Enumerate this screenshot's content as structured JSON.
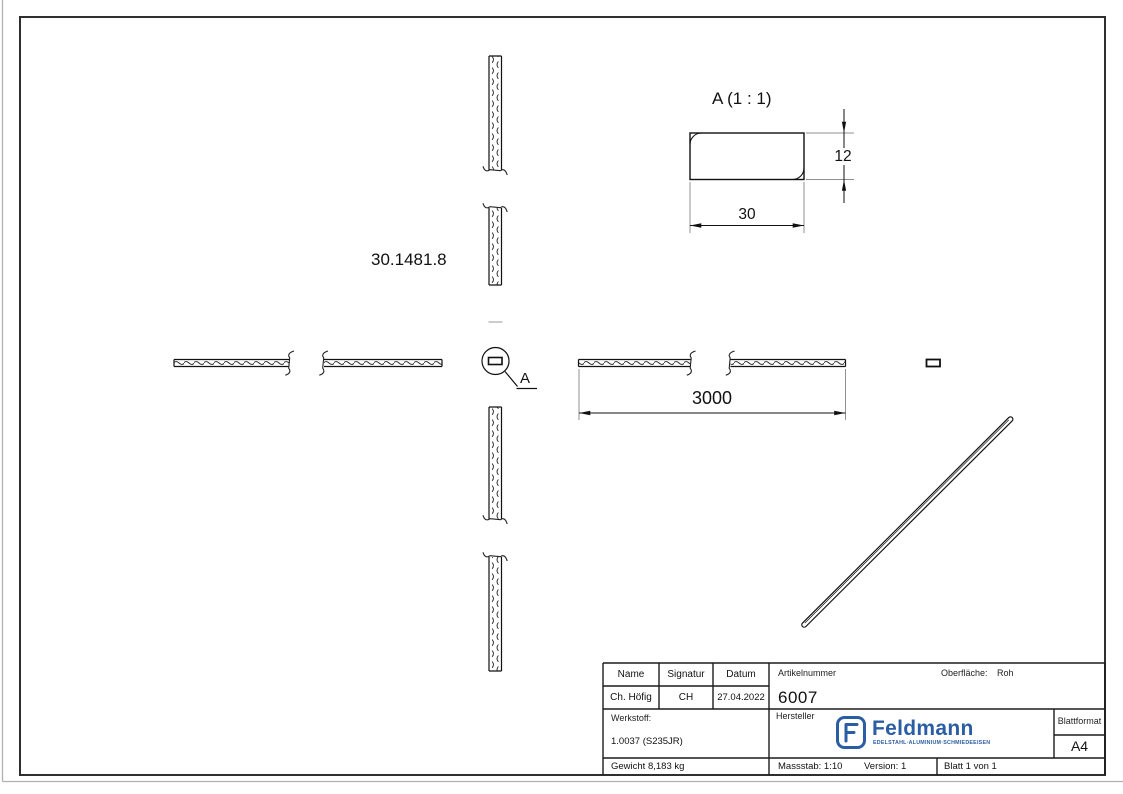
{
  "sheet": {
    "part_number": "30.1481.8",
    "detail_title": "A (1 : 1)",
    "dim_height": "12",
    "dim_width": "30",
    "dim_length": "3000",
    "callout_label": "A"
  },
  "title_block": {
    "col_name": "Name",
    "col_signature": "Signatur",
    "col_date": "Datum",
    "name": "Ch. Höfig",
    "signature": "CH",
    "date": "27.04.2022",
    "article_label": "Artikelnummer",
    "article_value": "6007",
    "surface_label": "Oberfläche:",
    "surface_value": "Roh",
    "material_label": "Werkstoff:",
    "material_value": "1.0037 (S235JR)",
    "manufacturer_label": "Hersteller",
    "brand": "Feldmann",
    "brand_tagline": "EDELSTAHL·ALUMINIUM·SCHMIEDEEISEN",
    "brand_color": "#2b5da4",
    "format_label": "Blattformat",
    "format_value": "A4",
    "weight": "Gewicht 8,183 kg",
    "scale": "Massstab: 1:10",
    "version": "Version: 1",
    "page": "Blatt 1 von 1"
  }
}
